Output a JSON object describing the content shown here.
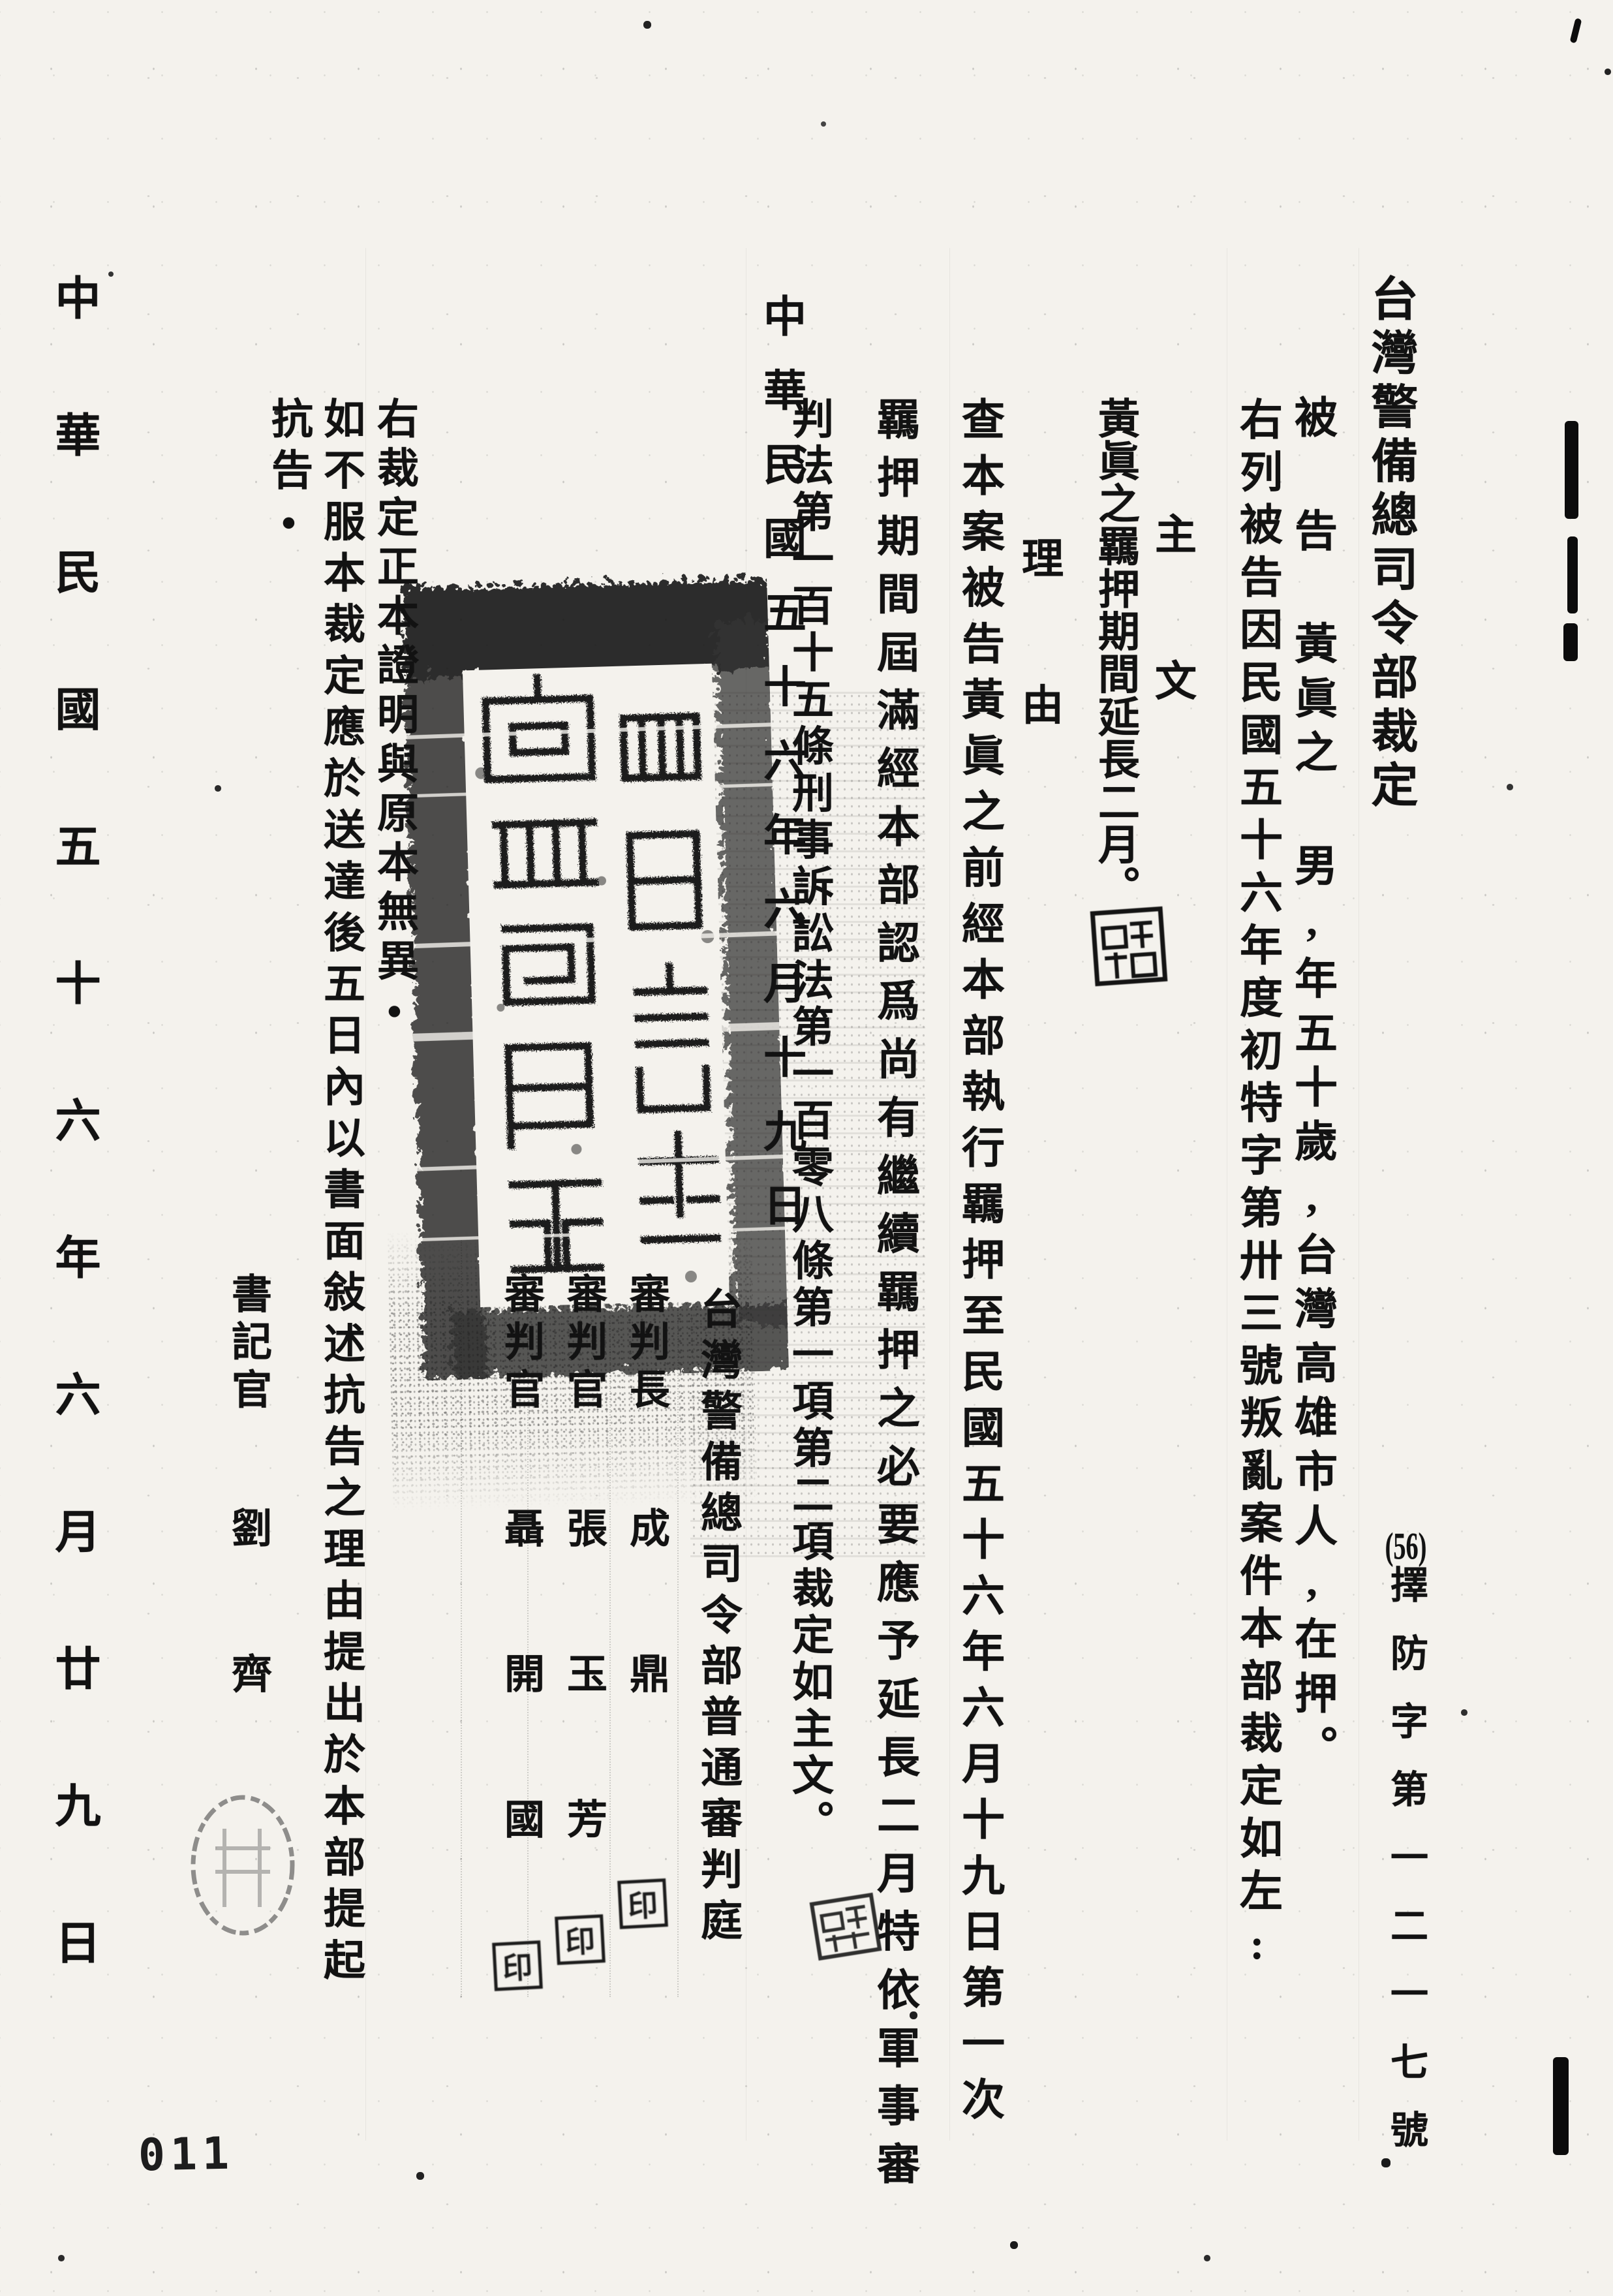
{
  "doc": {
    "title": "台灣警備總司令部裁定",
    "case_number_year": "(56)",
    "case_number_rest": "擇防字第一二一七號",
    "defendant_line": "被 告  黃眞之 男,年五十歲,台灣高雄市人,在押。",
    "preamble": "右列被告因民國五十六年度初特字第卅三號叛亂案件本部裁定如左:",
    "main_text_header": "主 文",
    "main_text": "黃眞之羈押期間延長二月。",
    "reason_header": "理 由",
    "reason_line1": "查本案被告黃眞之前經本部執行羈押至民國五十六年六月十九日第一次",
    "reason_line2": "羈押期間屆滿經本部認爲尚有繼續羈押之必要應予延長二月特依軍事審",
    "reason_line3": "判法第一百十五條刑事訴訟法第一百零八條第一項第二項裁定如主文。",
    "decision_date": "中華民國五十六年六月十九日",
    "court_name": "台灣警備總司令部普通審判庭",
    "presiding_judge_title": "審判長",
    "presiding_judge_name": "成 鼎",
    "judge2_title": "審判官",
    "judge2_name": "張 玉 芳",
    "judge3_title": "審判官",
    "judge3_name": "聶 開 國",
    "clerk_title": "書記官",
    "clerk_name": "劉 齊",
    "seal_label": "印",
    "certification": "右裁定正本證明與原本無異•",
    "appeal_notice_line1": "如不服本裁定應於送達後五日內以書面敍述抗告之理由提出於本部提起",
    "appeal_notice_line2": "抗告•",
    "service_date": "中華民國五十六年六月廿九日",
    "page_number_label": "011"
  }
}
